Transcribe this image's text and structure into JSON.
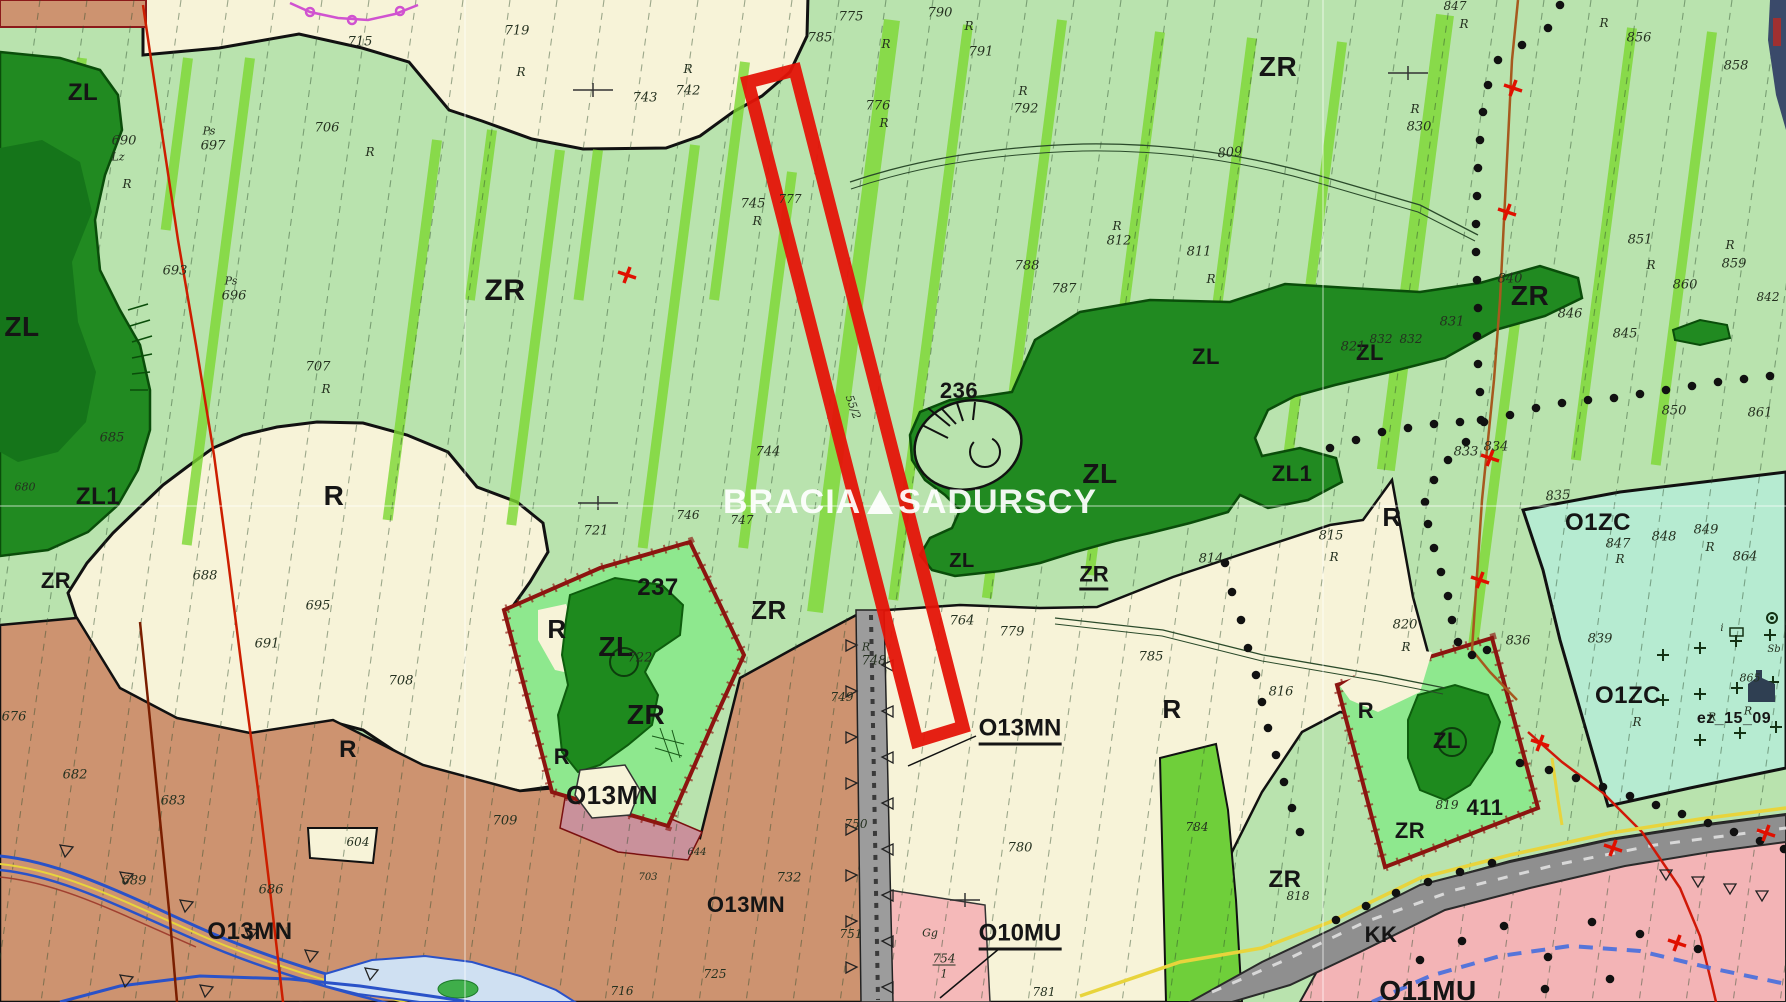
{
  "map": {
    "type": "zoning-plan-map",
    "watermark": {
      "pre": "BRACIA",
      "post": "SADURSCY"
    },
    "highlighted_plot": {
      "name": "offered-parcel-outline",
      "color": "#e41408"
    },
    "zone_colors": {
      "ZR_green": "#b9e3ae",
      "R_cream": "#f7f3d8",
      "ZL_forest": "#218a21",
      "ZL_forest_dark": "#15751a",
      "O13MN_brown": "#cd9370",
      "O10MU_pink": "#f5b9b9",
      "O11MU_pink": "#f3b4b6",
      "O1ZC_mint": "#b6ebd1",
      "plot_mint": "#8ee88e",
      "railway_gray": "#8f8f8f",
      "stripe_green": "#7cd832"
    }
  },
  "labels": [
    {
      "t": "ZR",
      "x": 505,
      "y": 291,
      "s": 30,
      "c": "z"
    },
    {
      "t": "ZR",
      "x": 1278,
      "y": 67,
      "s": 28,
      "c": "z"
    },
    {
      "t": "ZR",
      "x": 1530,
      "y": 296,
      "s": 28,
      "c": "z"
    },
    {
      "t": "ZR",
      "x": 769,
      "y": 610,
      "s": 26,
      "c": "z"
    },
    {
      "t": "ZR",
      "x": 56,
      "y": 581,
      "s": 22,
      "c": "z"
    },
    {
      "t": "ZR",
      "x": 1094,
      "y": 577,
      "s": 22,
      "c": "zu"
    },
    {
      "t": "ZR",
      "x": 646,
      "y": 715,
      "s": 28,
      "c": "z"
    },
    {
      "t": "ZR",
      "x": 1285,
      "y": 880,
      "s": 24,
      "c": "z"
    },
    {
      "t": "ZR",
      "x": 1410,
      "y": 831,
      "s": 22,
      "c": "z"
    },
    {
      "t": "ZL",
      "x": 83,
      "y": 93,
      "s": 24,
      "c": "z"
    },
    {
      "t": "ZL",
      "x": 22,
      "y": 327,
      "s": 28,
      "c": "z"
    },
    {
      "t": "ZL1",
      "x": 98,
      "y": 497,
      "s": 24,
      "c": "z"
    },
    {
      "t": "ZL",
      "x": 1100,
      "y": 474,
      "s": 28,
      "c": "z"
    },
    {
      "t": "ZL1",
      "x": 1292,
      "y": 474,
      "s": 22,
      "c": "z"
    },
    {
      "t": "ZL",
      "x": 1206,
      "y": 357,
      "s": 22,
      "c": "z"
    },
    {
      "t": "ZL",
      "x": 1370,
      "y": 353,
      "s": 22,
      "c": "z"
    },
    {
      "t": "ZL",
      "x": 962,
      "y": 561,
      "s": 20,
      "c": "z"
    },
    {
      "t": "ZL",
      "x": 616,
      "y": 647,
      "s": 28,
      "c": "z"
    },
    {
      "t": "ZL",
      "x": 1447,
      "y": 741,
      "s": 22,
      "c": "z"
    },
    {
      "t": "R",
      "x": 334,
      "y": 496,
      "s": 28,
      "c": "z"
    },
    {
      "t": "R",
      "x": 348,
      "y": 750,
      "s": 24,
      "c": "z"
    },
    {
      "t": "R",
      "x": 557,
      "y": 629,
      "s": 26,
      "c": "z"
    },
    {
      "t": "R",
      "x": 562,
      "y": 757,
      "s": 22,
      "c": "z"
    },
    {
      "t": "R",
      "x": 1172,
      "y": 709,
      "s": 26,
      "c": "z"
    },
    {
      "t": "R",
      "x": 1366,
      "y": 711,
      "s": 22,
      "c": "z"
    },
    {
      "t": "R",
      "x": 1392,
      "y": 517,
      "s": 26,
      "c": "z"
    },
    {
      "t": "O13MN",
      "x": 612,
      "y": 795,
      "s": 26,
      "c": "z"
    },
    {
      "t": "O13MN",
      "x": 250,
      "y": 932,
      "s": 24,
      "c": "z"
    },
    {
      "t": "O13MN",
      "x": 746,
      "y": 905,
      "s": 22,
      "c": "z"
    },
    {
      "t": "O13MN",
      "x": 1020,
      "y": 731,
      "s": 24,
      "c": "zu"
    },
    {
      "t": "O10MU",
      "x": 1020,
      "y": 936,
      "s": 24,
      "c": "zu"
    },
    {
      "t": "O11MU",
      "x": 1428,
      "y": 991,
      "s": 28,
      "c": "z"
    },
    {
      "t": "O1ZC",
      "x": 1598,
      "y": 523,
      "s": 24,
      "c": "z"
    },
    {
      "t": "O1ZC",
      "x": 1628,
      "y": 696,
      "s": 24,
      "c": "z"
    },
    {
      "t": "KK",
      "x": 1381,
      "y": 935,
      "s": 22,
      "c": "z"
    },
    {
      "t": "236",
      "x": 959,
      "y": 391,
      "s": 22,
      "c": "z"
    },
    {
      "t": "237",
      "x": 658,
      "y": 588,
      "s": 24,
      "c": "z"
    },
    {
      "t": "411",
      "x": 1485,
      "y": 808,
      "s": 22,
      "c": "z"
    },
    {
      "t": "ez_15_09",
      "x": 1734,
      "y": 719,
      "s": 16,
      "c": "z"
    },
    {
      "t": "690",
      "x": 124,
      "y": 141,
      "s": 13,
      "c": "p"
    },
    {
      "t": "Lz",
      "x": 118,
      "y": 157,
      "s": 11,
      "c": "p"
    },
    {
      "t": "R",
      "x": 127,
      "y": 184,
      "s": 12,
      "c": "p"
    },
    {
      "t": "Ps",
      "x": 209,
      "y": 131,
      "s": 11,
      "c": "p"
    },
    {
      "t": "697",
      "x": 213,
      "y": 146,
      "s": 13,
      "c": "p"
    },
    {
      "t": "693",
      "x": 175,
      "y": 271,
      "s": 13,
      "c": "p"
    },
    {
      "t": "Ps",
      "x": 231,
      "y": 281,
      "s": 11,
      "c": "p"
    },
    {
      "t": "696",
      "x": 234,
      "y": 296,
      "s": 13,
      "c": "p"
    },
    {
      "t": "706",
      "x": 327,
      "y": 128,
      "s": 13,
      "c": "p"
    },
    {
      "t": "R",
      "x": 370,
      "y": 152,
      "s": 12,
      "c": "p"
    },
    {
      "t": "715",
      "x": 360,
      "y": 42,
      "s": 13,
      "c": "p"
    },
    {
      "t": "719",
      "x": 517,
      "y": 31,
      "s": 13,
      "c": "p"
    },
    {
      "t": "R",
      "x": 521,
      "y": 72,
      "s": 12,
      "c": "p"
    },
    {
      "t": "743",
      "x": 645,
      "y": 98,
      "s": 13,
      "c": "p"
    },
    {
      "t": "742",
      "x": 688,
      "y": 91,
      "s": 13,
      "c": "p"
    },
    {
      "t": "R",
      "x": 688,
      "y": 69,
      "s": 12,
      "c": "p"
    },
    {
      "t": "775",
      "x": 851,
      "y": 17,
      "s": 13,
      "c": "p"
    },
    {
      "t": "785",
      "x": 820,
      "y": 38,
      "s": 13,
      "c": "p"
    },
    {
      "t": "776",
      "x": 878,
      "y": 106,
      "s": 13,
      "c": "p"
    },
    {
      "t": "R",
      "x": 884,
      "y": 123,
      "s": 12,
      "c": "p"
    },
    {
      "t": "790",
      "x": 940,
      "y": 13,
      "s": 13,
      "c": "p"
    },
    {
      "t": "R",
      "x": 886,
      "y": 44,
      "s": 12,
      "c": "p"
    },
    {
      "t": "791",
      "x": 981,
      "y": 52,
      "s": 13,
      "c": "p"
    },
    {
      "t": "R",
      "x": 969,
      "y": 26,
      "s": 12,
      "c": "p"
    },
    {
      "t": "792",
      "x": 1026,
      "y": 109,
      "s": 13,
      "c": "p"
    },
    {
      "t": "R",
      "x": 1023,
      "y": 91,
      "s": 12,
      "c": "p"
    },
    {
      "t": "745",
      "x": 753,
      "y": 204,
      "s": 13,
      "c": "p"
    },
    {
      "t": "R",
      "x": 757,
      "y": 221,
      "s": 12,
      "c": "p"
    },
    {
      "t": "777",
      "x": 790,
      "y": 199,
      "s": 12,
      "c": "p"
    },
    {
      "t": "809",
      "x": 1230,
      "y": 153,
      "s": 13,
      "c": "p",
      "r": -4
    },
    {
      "t": "812",
      "x": 1119,
      "y": 241,
      "s": 13,
      "c": "p"
    },
    {
      "t": "R",
      "x": 1117,
      "y": 226,
      "s": 12,
      "c": "p"
    },
    {
      "t": "811",
      "x": 1199,
      "y": 252,
      "s": 13,
      "c": "p"
    },
    {
      "t": "R",
      "x": 1211,
      "y": 279,
      "s": 12,
      "c": "p"
    },
    {
      "t": "788",
      "x": 1027,
      "y": 266,
      "s": 13,
      "c": "p"
    },
    {
      "t": "787",
      "x": 1064,
      "y": 289,
      "s": 13,
      "c": "p"
    },
    {
      "t": "707",
      "x": 318,
      "y": 367,
      "s": 13,
      "c": "p"
    },
    {
      "t": "R",
      "x": 326,
      "y": 389,
      "s": 12,
      "c": "p"
    },
    {
      "t": "685",
      "x": 112,
      "y": 438,
      "s": 13,
      "c": "p"
    },
    {
      "t": "680",
      "x": 25,
      "y": 487,
      "s": 11,
      "c": "p"
    },
    {
      "t": "688",
      "x": 205,
      "y": 576,
      "s": 13,
      "c": "p"
    },
    {
      "t": "695",
      "x": 318,
      "y": 606,
      "s": 13,
      "c": "p"
    },
    {
      "t": "691",
      "x": 267,
      "y": 644,
      "s": 13,
      "c": "p"
    },
    {
      "t": "721",
      "x": 596,
      "y": 531,
      "s": 13,
      "c": "p"
    },
    {
      "t": "722",
      "x": 640,
      "y": 658,
      "s": 13,
      "c": "p"
    },
    {
      "t": "55/2",
      "x": 853,
      "y": 407,
      "s": 11,
      "c": "p",
      "r": 70
    },
    {
      "t": "744",
      "x": 768,
      "y": 452,
      "s": 13,
      "c": "p"
    },
    {
      "t": "746",
      "x": 688,
      "y": 515,
      "s": 12,
      "c": "p"
    },
    {
      "t": "747",
      "x": 742,
      "y": 520,
      "s": 12,
      "c": "p"
    },
    {
      "t": "764",
      "x": 962,
      "y": 621,
      "s": 13,
      "c": "p"
    },
    {
      "t": "779",
      "x": 1012,
      "y": 632,
      "s": 13,
      "c": "p"
    },
    {
      "t": "748",
      "x": 874,
      "y": 661,
      "s": 13,
      "c": "p"
    },
    {
      "t": "R",
      "x": 866,
      "y": 647,
      "s": 11,
      "c": "p"
    },
    {
      "t": "749",
      "x": 842,
      "y": 697,
      "s": 12,
      "c": "p"
    },
    {
      "t": "750",
      "x": 856,
      "y": 824,
      "s": 12,
      "c": "p"
    },
    {
      "t": "732",
      "x": 789,
      "y": 878,
      "s": 13,
      "c": "p"
    },
    {
      "t": "751",
      "x": 851,
      "y": 934,
      "s": 12,
      "c": "p"
    },
    {
      "t": "725",
      "x": 715,
      "y": 974,
      "s": 12,
      "c": "p"
    },
    {
      "t": "716",
      "x": 622,
      "y": 991,
      "s": 12,
      "c": "p"
    },
    {
      "t": "Gg",
      "x": 930,
      "y": 933,
      "s": 11,
      "c": "p"
    },
    {
      "t": "754",
      "x": 944,
      "y": 959,
      "s": 12,
      "c": "pf"
    },
    {
      "t": "1",
      "x": 944,
      "y": 974,
      "s": 11,
      "c": "p"
    },
    {
      "t": "780",
      "x": 1020,
      "y": 848,
      "s": 13,
      "c": "p"
    },
    {
      "t": "781",
      "x": 1044,
      "y": 992,
      "s": 12,
      "c": "p"
    },
    {
      "t": "644",
      "x": 697,
      "y": 853,
      "s": 10,
      "c": "p"
    },
    {
      "t": "703",
      "x": 648,
      "y": 878,
      "s": 10,
      "c": "p"
    },
    {
      "t": "676",
      "x": 14,
      "y": 717,
      "s": 13,
      "c": "p"
    },
    {
      "t": "682",
      "x": 75,
      "y": 775,
      "s": 13,
      "c": "p"
    },
    {
      "t": "683",
      "x": 173,
      "y": 801,
      "s": 13,
      "c": "p"
    },
    {
      "t": "689",
      "x": 134,
      "y": 881,
      "s": 13,
      "c": "p"
    },
    {
      "t": "686",
      "x": 271,
      "y": 890,
      "s": 13,
      "c": "p"
    },
    {
      "t": "604",
      "x": 358,
      "y": 842,
      "s": 12,
      "c": "p"
    },
    {
      "t": "708",
      "x": 401,
      "y": 681,
      "s": 13,
      "c": "p"
    },
    {
      "t": "709",
      "x": 505,
      "y": 821,
      "s": 13,
      "c": "p"
    },
    {
      "t": "814",
      "x": 1211,
      "y": 559,
      "s": 13,
      "c": "p"
    },
    {
      "t": "815",
      "x": 1331,
      "y": 536,
      "s": 13,
      "c": "p"
    },
    {
      "t": "820",
      "x": 1405,
      "y": 625,
      "s": 13,
      "c": "p"
    },
    {
      "t": "785",
      "x": 1151,
      "y": 657,
      "s": 13,
      "c": "p"
    },
    {
      "t": "816",
      "x": 1281,
      "y": 692,
      "s": 13,
      "c": "p"
    },
    {
      "t": "R",
      "x": 1334,
      "y": 557,
      "s": 12,
      "c": "p"
    },
    {
      "t": "R",
      "x": 1406,
      "y": 647,
      "s": 12,
      "c": "p"
    },
    {
      "t": "821",
      "x": 1353,
      "y": 347,
      "s": 13,
      "c": "p"
    },
    {
      "t": "832",
      "x": 1381,
      "y": 339,
      "s": 12,
      "c": "p"
    },
    {
      "t": "832",
      "x": 1411,
      "y": 339,
      "s": 12,
      "c": "p"
    },
    {
      "t": "831",
      "x": 1452,
      "y": 322,
      "s": 13,
      "c": "p"
    },
    {
      "t": "833",
      "x": 1466,
      "y": 452,
      "s": 13,
      "c": "p"
    },
    {
      "t": "834",
      "x": 1496,
      "y": 447,
      "s": 13,
      "c": "p"
    },
    {
      "t": "835",
      "x": 1558,
      "y": 496,
      "s": 13,
      "c": "p",
      "r": -4
    },
    {
      "t": "836",
      "x": 1518,
      "y": 641,
      "s": 13,
      "c": "p"
    },
    {
      "t": "846",
      "x": 1570,
      "y": 314,
      "s": 13,
      "c": "p"
    },
    {
      "t": "845",
      "x": 1625,
      "y": 334,
      "s": 13,
      "c": "p"
    },
    {
      "t": "850",
      "x": 1674,
      "y": 411,
      "s": 13,
      "c": "p"
    },
    {
      "t": "861",
      "x": 1760,
      "y": 413,
      "s": 13,
      "c": "p"
    },
    {
      "t": "847",
      "x": 1618,
      "y": 544,
      "s": 13,
      "c": "p"
    },
    {
      "t": "848",
      "x": 1664,
      "y": 537,
      "s": 13,
      "c": "p"
    },
    {
      "t": "849",
      "x": 1706,
      "y": 530,
      "s": 13,
      "c": "p"
    },
    {
      "t": "864",
      "x": 1745,
      "y": 557,
      "s": 13,
      "c": "p"
    },
    {
      "t": "839",
      "x": 1600,
      "y": 639,
      "s": 13,
      "c": "p"
    },
    {
      "t": "R",
      "x": 1620,
      "y": 559,
      "s": 12,
      "c": "p"
    },
    {
      "t": "R",
      "x": 1710,
      "y": 547,
      "s": 12,
      "c": "p"
    },
    {
      "t": "830",
      "x": 1419,
      "y": 127,
      "s": 13,
      "c": "p"
    },
    {
      "t": "R",
      "x": 1415,
      "y": 109,
      "s": 12,
      "c": "p"
    },
    {
      "t": "847",
      "x": 1455,
      "y": 6,
      "s": 12,
      "c": "p"
    },
    {
      "t": "R",
      "x": 1464,
      "y": 24,
      "s": 12,
      "c": "p"
    },
    {
      "t": "856",
      "x": 1639,
      "y": 38,
      "s": 13,
      "c": "p"
    },
    {
      "t": "R",
      "x": 1604,
      "y": 23,
      "s": 12,
      "c": "p"
    },
    {
      "t": "858",
      "x": 1736,
      "y": 66,
      "s": 13,
      "c": "p"
    },
    {
      "t": "851",
      "x": 1640,
      "y": 240,
      "s": 13,
      "c": "p"
    },
    {
      "t": "R",
      "x": 1651,
      "y": 265,
      "s": 12,
      "c": "p"
    },
    {
      "t": "859",
      "x": 1734,
      "y": 264,
      "s": 13,
      "c": "p"
    },
    {
      "t": "860",
      "x": 1685,
      "y": 285,
      "s": 13,
      "c": "p"
    },
    {
      "t": "840",
      "x": 1510,
      "y": 279,
      "s": 13,
      "c": "p"
    },
    {
      "t": "842",
      "x": 1768,
      "y": 297,
      "s": 12,
      "c": "p"
    },
    {
      "t": "R",
      "x": 1730,
      "y": 245,
      "s": 12,
      "c": "p"
    },
    {
      "t": "865",
      "x": 1750,
      "y": 678,
      "s": 11,
      "c": "p"
    },
    {
      "t": "819",
      "x": 1447,
      "y": 805,
      "s": 12,
      "c": "p"
    },
    {
      "t": "818",
      "x": 1298,
      "y": 896,
      "s": 12,
      "c": "p"
    },
    {
      "t": "784",
      "x": 1197,
      "y": 827,
      "s": 12,
      "c": "p"
    },
    {
      "t": "Sb",
      "x": 1774,
      "y": 650,
      "s": 10,
      "c": "p"
    },
    {
      "t": "i",
      "x": 1722,
      "y": 629,
      "s": 10,
      "c": "p"
    },
    {
      "t": "R",
      "x": 1637,
      "y": 722,
      "s": 12,
      "c": "p"
    },
    {
      "t": "R",
      "x": 1712,
      "y": 717,
      "s": 11,
      "c": "p"
    },
    {
      "t": "R",
      "x": 1748,
      "y": 711,
      "s": 11,
      "c": "p"
    }
  ]
}
